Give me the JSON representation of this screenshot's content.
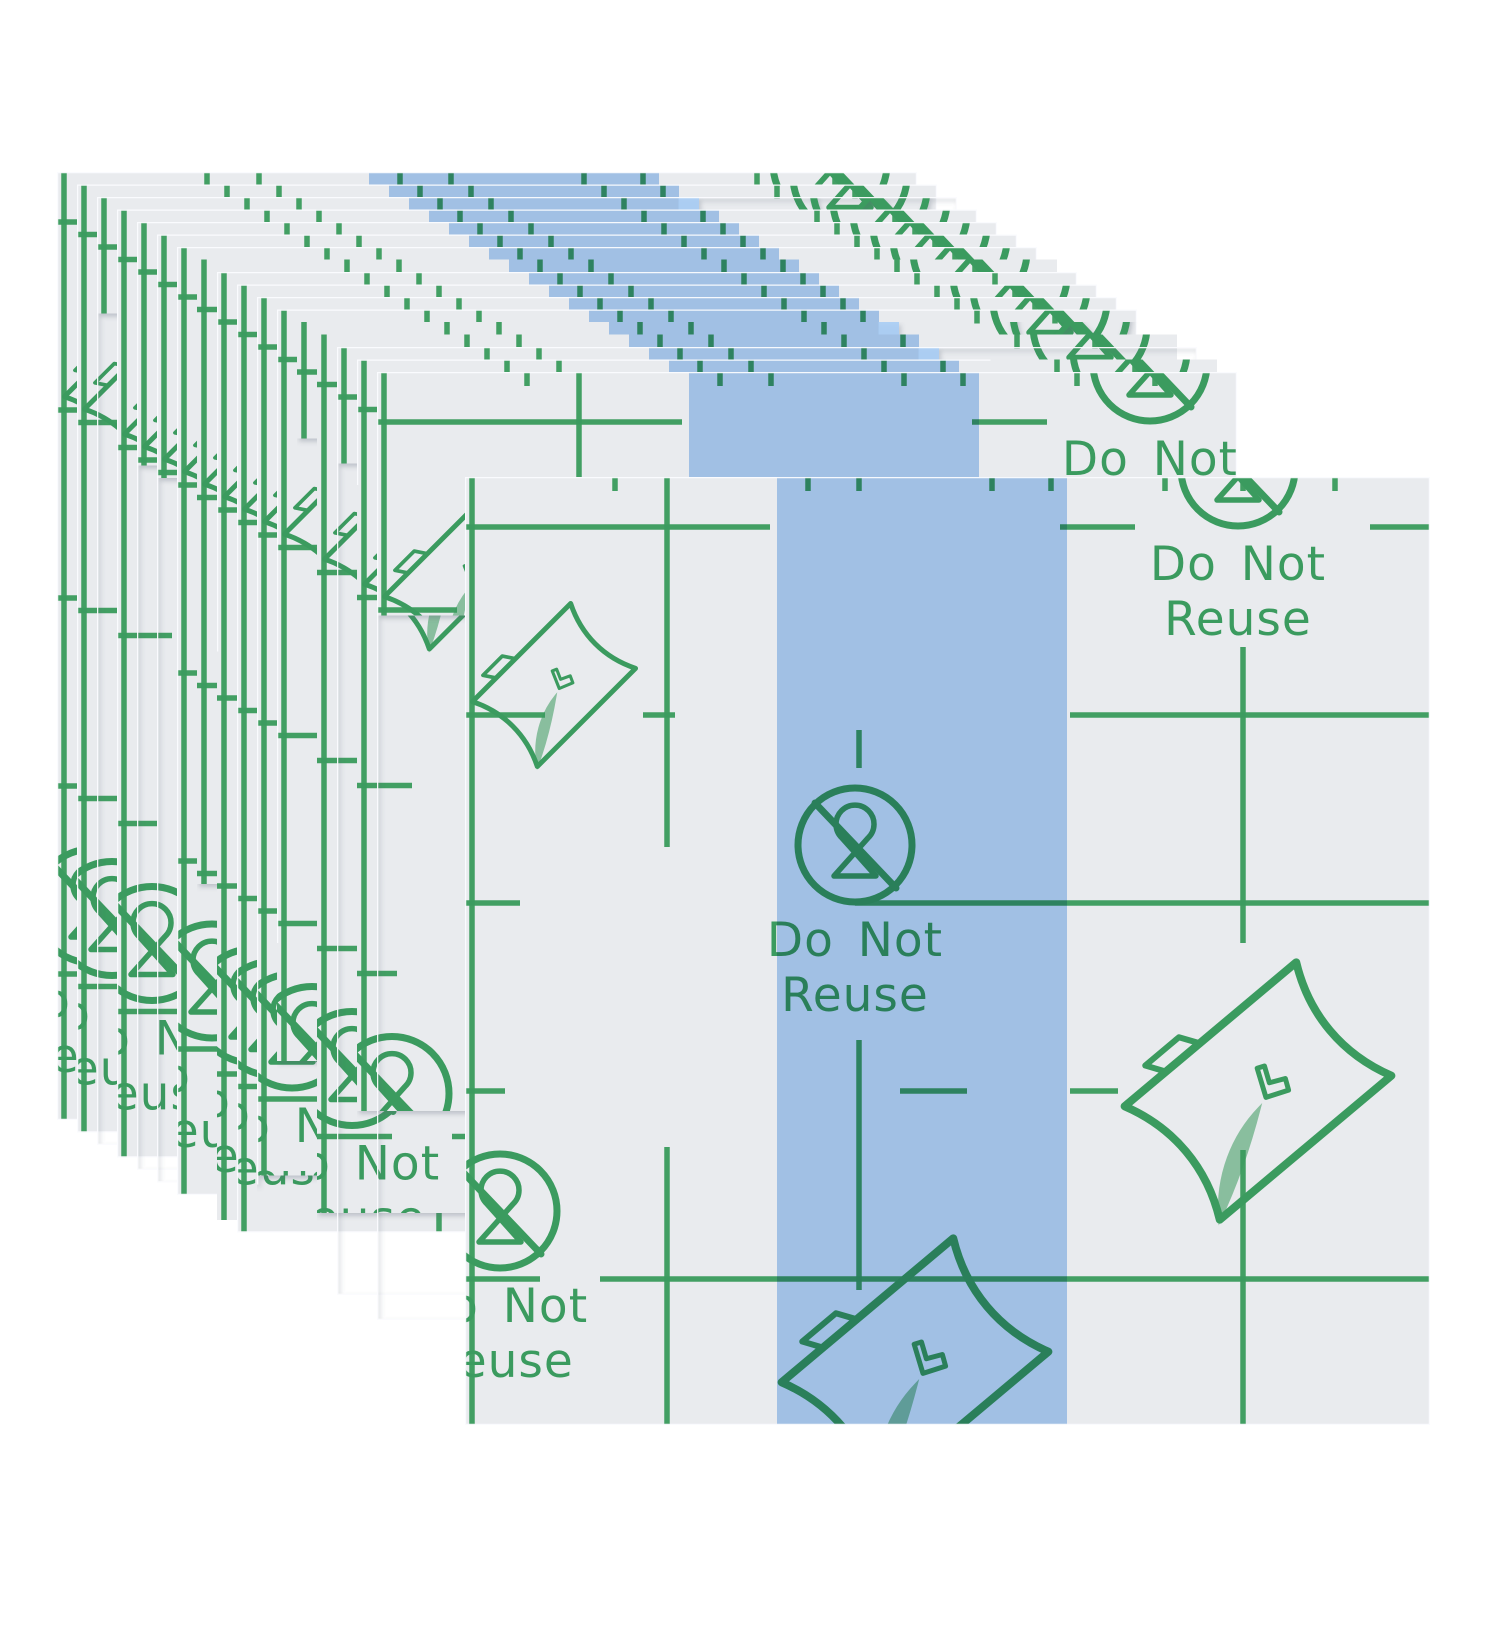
{
  "image": {
    "kind": "product-photo",
    "alt": "Stack of transparent waterproof adhesive film sheets with green alignment grid printing, Do Not Reuse symbols, peel-corner instruction icons and a light blue center release-liner stripe; one full sheet displayed in front of the fanned stack"
  },
  "colors": {
    "background": "#ffffff",
    "sheet": "#e9ebee",
    "sheet_edge": "#fbfcfe",
    "stripe_blue": "#a9cdf5",
    "print_green": "#3b9b5e"
  },
  "print": {
    "do_not": "Do Not",
    "reuse": "Reuse"
  },
  "icons": [
    "no-reuse-hourglass-icon",
    "peel-corner-icon"
  ],
  "layout": {
    "stack": {
      "count": 17,
      "x": 57,
      "y": 172,
      "dx": 20,
      "dy": 12.5,
      "sheet_width": 860,
      "sheet_height": 948
    },
    "front_sheet": {
      "x": 465,
      "y": 477,
      "width": 965,
      "height": 948
    },
    "stripe": {
      "x": 312,
      "width": 290
    }
  }
}
